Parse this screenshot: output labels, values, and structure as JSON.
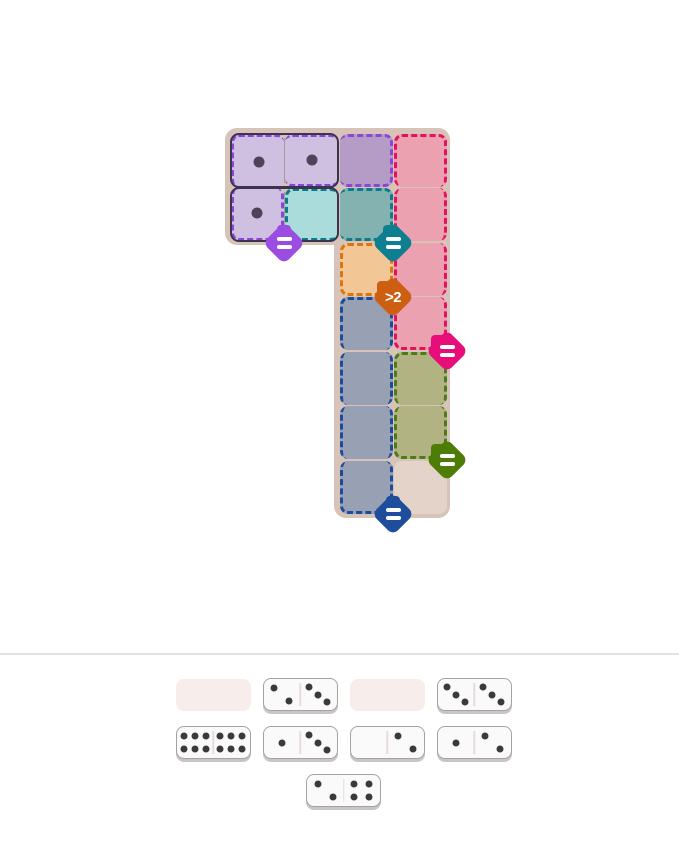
{
  "board": {
    "bg_color": "#d7c3b7",
    "origin": {
      "x": 225,
      "y": 128
    },
    "cell_size": 53,
    "pitch": 54.5,
    "padding": 5.5,
    "size": {
      "w": 225,
      "h": 390
    },
    "blocks": [
      {
        "x": 0,
        "y": 0,
        "w": 225,
        "h": 117
      },
      {
        "x": 109,
        "y": 0,
        "w": 116,
        "h": 390
      }
    ]
  },
  "regions": [
    {
      "name": "purple-equal-region",
      "constraint": "=",
      "border_color": "#8a46d6",
      "cells": [
        {
          "row": 1,
          "col": 1,
          "fill": "#cfc0e2",
          "dashes": "tl",
          "pips": 1
        },
        {
          "row": 1,
          "col": 2,
          "fill": "#cfc0e2",
          "dashes": "tb",
          "pips": 1
        },
        {
          "row": 1,
          "col": 3,
          "fill": "#b59cc6",
          "dashes": "trb",
          "pips": 0
        },
        {
          "row": 2,
          "col": 1,
          "fill": "#cfc0e2",
          "dashes": "rbl",
          "pips": 1
        }
      ]
    },
    {
      "name": "teal-equal-region",
      "constraint": "=",
      "border_color": "#0c7b8b",
      "cells": [
        {
          "row": 2,
          "col": 2,
          "fill": "#a9dcdb",
          "dashes": "tbl",
          "pips": 0
        },
        {
          "row": 2,
          "col": 3,
          "fill": "#83b2b0",
          "dashes": "trb",
          "pips": 0
        }
      ]
    },
    {
      "name": "pink-equal-region",
      "constraint": "=",
      "border_color": "#e7105c",
      "cells": [
        {
          "row": 1,
          "col": 4,
          "fill": "#eca1b1",
          "dashes": "trl",
          "pips": 0
        },
        {
          "row": 2,
          "col": 4,
          "fill": "#eca1b1",
          "dashes": "rl",
          "pips": 0
        },
        {
          "row": 3,
          "col": 4,
          "fill": "#eca1b1",
          "dashes": "rl",
          "pips": 0
        },
        {
          "row": 4,
          "col": 4,
          "fill": "#eca1b1",
          "dashes": "rbl",
          "pips": 0
        }
      ]
    },
    {
      "name": "orange-greater-than-2-region",
      "constraint": ">2",
      "border_color": "#dc7613",
      "cells": [
        {
          "row": 3,
          "col": 3,
          "fill": "#f3c795",
          "dashes": "trbl",
          "pips": 0
        }
      ]
    },
    {
      "name": "navy-equal-region",
      "constraint": "=",
      "border_color": "#1c4a9d",
      "cells": [
        {
          "row": 4,
          "col": 3,
          "fill": "#98a0b3",
          "dashes": "trl",
          "pips": 0
        },
        {
          "row": 5,
          "col": 3,
          "fill": "#98a0b3",
          "dashes": "rl",
          "pips": 0
        },
        {
          "row": 6,
          "col": 3,
          "fill": "#98a0b3",
          "dashes": "rl",
          "pips": 0
        },
        {
          "row": 7,
          "col": 3,
          "fill": "#98a0b3",
          "dashes": "rbl",
          "pips": 0
        }
      ]
    },
    {
      "name": "olive-equal-region",
      "constraint": "=",
      "border_color": "#4d7b17",
      "cells": [
        {
          "row": 5,
          "col": 4,
          "fill": "#b2b383",
          "dashes": "trl",
          "pips": 0
        },
        {
          "row": 6,
          "col": 4,
          "fill": "#b2b383",
          "dashes": "rbl",
          "pips": 0
        }
      ]
    },
    {
      "name": "neutral-region",
      "constraint": "",
      "border_color": "",
      "cells": [
        {
          "row": 7,
          "col": 4,
          "fill": "#e3d3c9",
          "dashes": "",
          "pips": 0
        }
      ]
    }
  ],
  "placed_dominoes": [
    {
      "name": "placed-domino-1-1",
      "row": 1,
      "cols": [
        1,
        2
      ],
      "pips": [
        1,
        1
      ]
    },
    {
      "name": "placed-domino-1-0",
      "row": 2,
      "cols": [
        1,
        2
      ],
      "pips": [
        1,
        0
      ]
    }
  ],
  "badges": [
    {
      "name": "purple-equal-badge",
      "label": "=",
      "color": "#9b4ce1",
      "x": 284,
      "y": 243,
      "tab": [
        0,
        -11
      ]
    },
    {
      "name": "teal-equal-badge",
      "label": "=",
      "color": "#0d7f90",
      "x": 393,
      "y": 243,
      "tab": [
        -3,
        -11
      ]
    },
    {
      "name": "orange-greater-than-2-badge",
      "label": ">2",
      "color": "#cd5f13",
      "x": 393,
      "y": 297,
      "tab": [
        -9,
        -9
      ]
    },
    {
      "name": "magenta-equal-badge",
      "label": "=",
      "color": "#e80e7a",
      "x": 447,
      "y": 351,
      "tab": [
        -9,
        -9
      ]
    },
    {
      "name": "olive-equal-badge",
      "label": "=",
      "color": "#4e7d07",
      "x": 447,
      "y": 460,
      "tab": [
        -9,
        -9
      ]
    },
    {
      "name": "navy-equal-badge",
      "label": "=",
      "color": "#1e4d9c",
      "x": 393,
      "y": 514,
      "tab": [
        0,
        -11
      ]
    }
  ],
  "style": {
    "domino_outline": "#3a3450",
    "board_pip": "#4c4358",
    "tray_pip": "#3a3a3a",
    "tray_domino_bg": "#fbfafa",
    "tray_domino_border": "#a6a2a2",
    "tray_slot_bg": "#f7eeec",
    "divider_color": "#e2e2e2"
  },
  "tray": {
    "rows": [
      [
        {
          "type": "slot"
        },
        {
          "type": "domino",
          "pips": [
            2,
            3
          ]
        },
        {
          "type": "slot"
        },
        {
          "type": "domino",
          "pips": [
            3,
            3
          ]
        }
      ],
      [
        {
          "type": "domino",
          "pips": [
            6,
            6
          ]
        },
        {
          "type": "domino",
          "pips": [
            1,
            3
          ]
        },
        {
          "type": "domino",
          "pips": [
            0,
            2
          ]
        },
        {
          "type": "domino",
          "pips": [
            1,
            2
          ]
        }
      ],
      [
        {
          "type": "domino",
          "pips": [
            2,
            4
          ]
        }
      ]
    ]
  }
}
